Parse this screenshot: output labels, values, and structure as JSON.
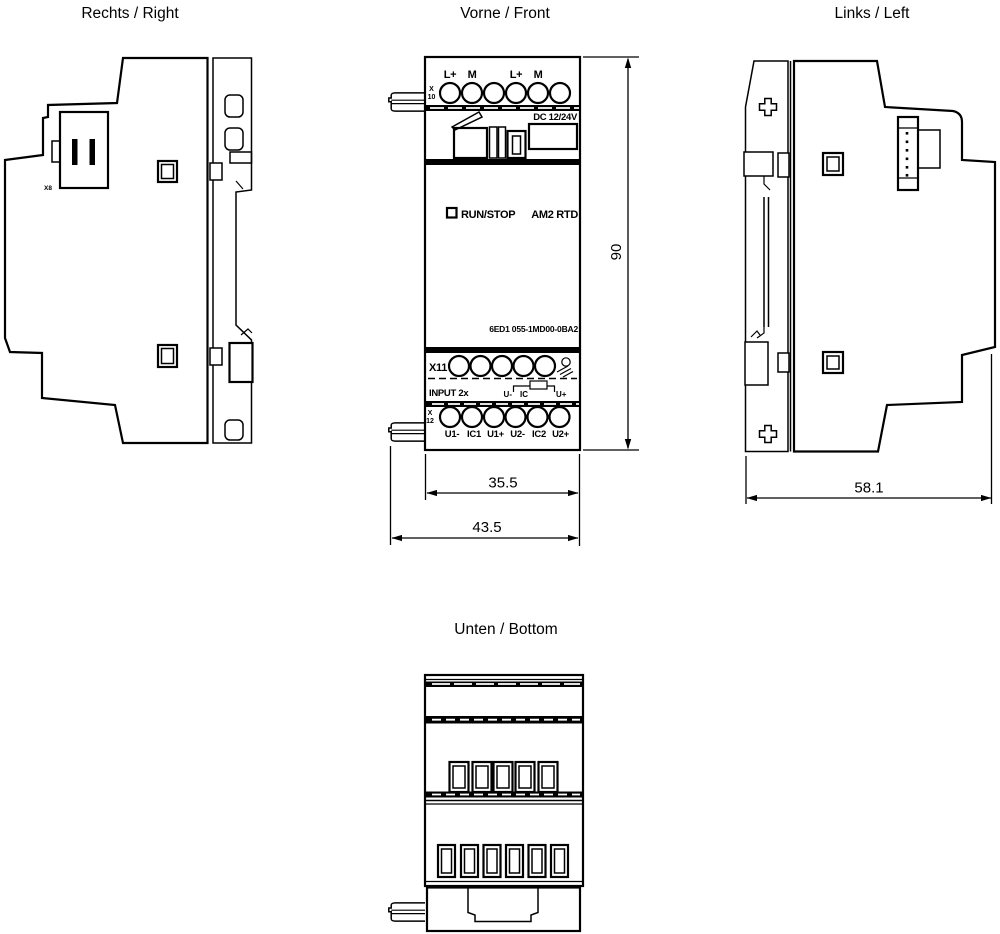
{
  "drawing": {
    "views": {
      "right": {
        "title": "Rechts / Right",
        "connector": "X8"
      },
      "front": {
        "title": "Vorne / Front",
        "power_terminals": {
          "id_line1": "X",
          "id_line2": "10",
          "labels": [
            "L+",
            "M",
            "L+",
            "M"
          ]
        },
        "supply": "DC 12/24V",
        "led": "RUN/STOP",
        "model": "AM2 RTD",
        "part_number": "6ED1 055-1MD00-0BA2",
        "sensor_header": {
          "id": "X11",
          "caption": "INPUT 2x",
          "schematic": {
            "left": "U-",
            "center": "IC",
            "right": "U+"
          }
        },
        "input_terminals": {
          "id_line1": "X",
          "id_line2": "12",
          "labels": [
            "U1-",
            "IC1",
            "U1+",
            "U2-",
            "IC2",
            "U2+"
          ]
        }
      },
      "left": {
        "title": "Links / Left"
      },
      "bottom": {
        "title": "Unten / Bottom"
      }
    },
    "dimensions_mm": {
      "height": "90",
      "body_width": "35.5",
      "overall_width": "43.5",
      "depth": "58.1"
    },
    "colors": {
      "line": "#000000",
      "background": "#ffffff"
    }
  }
}
